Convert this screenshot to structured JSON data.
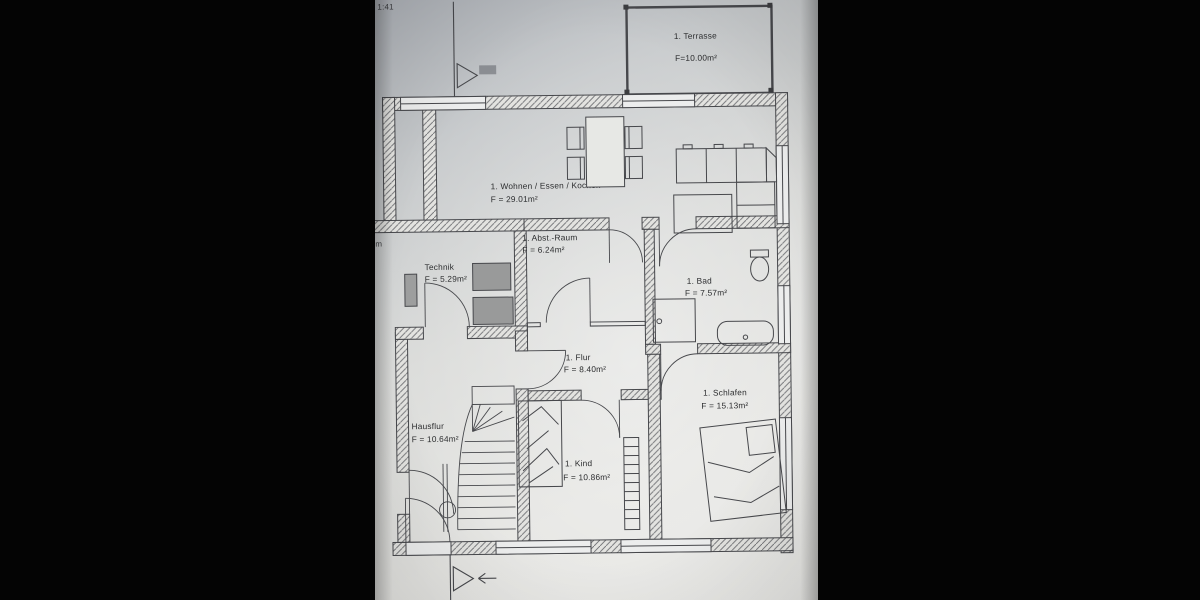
{
  "plan": {
    "rooms": {
      "terrasse": {
        "name": "1. Terrasse",
        "area": "F=10.00m²"
      },
      "wohnen": {
        "name": "1. Wohnen / Essen / Kochen",
        "area": "F = 29.01m²"
      },
      "abstraum": {
        "name": "1. Abst.-Raum",
        "area": "F = 6.24m²"
      },
      "technik": {
        "name": "Technik",
        "area": "F = 5.29m²"
      },
      "bad": {
        "name": "1. Bad",
        "area": "F = 7.57m²"
      },
      "flur": {
        "name": "1. Flur",
        "area": "F = 8.40m²"
      },
      "schlafen": {
        "name": "1. Schlafen",
        "area": "F = 15.13m²"
      },
      "hausflur": {
        "name": "Hausflur",
        "area": "F = 10.64m²"
      },
      "kind": {
        "name": "1. Kind",
        "area": "F = 10.86m²"
      }
    },
    "fragments": {
      "top_left": "1:41",
      "left_edge": "m"
    },
    "colors": {
      "background": "#050505",
      "paper": "#e4e4e1",
      "paper_shadow": "#adb1b7",
      "line": "#47484c",
      "appliance": "#999a9a"
    }
  }
}
